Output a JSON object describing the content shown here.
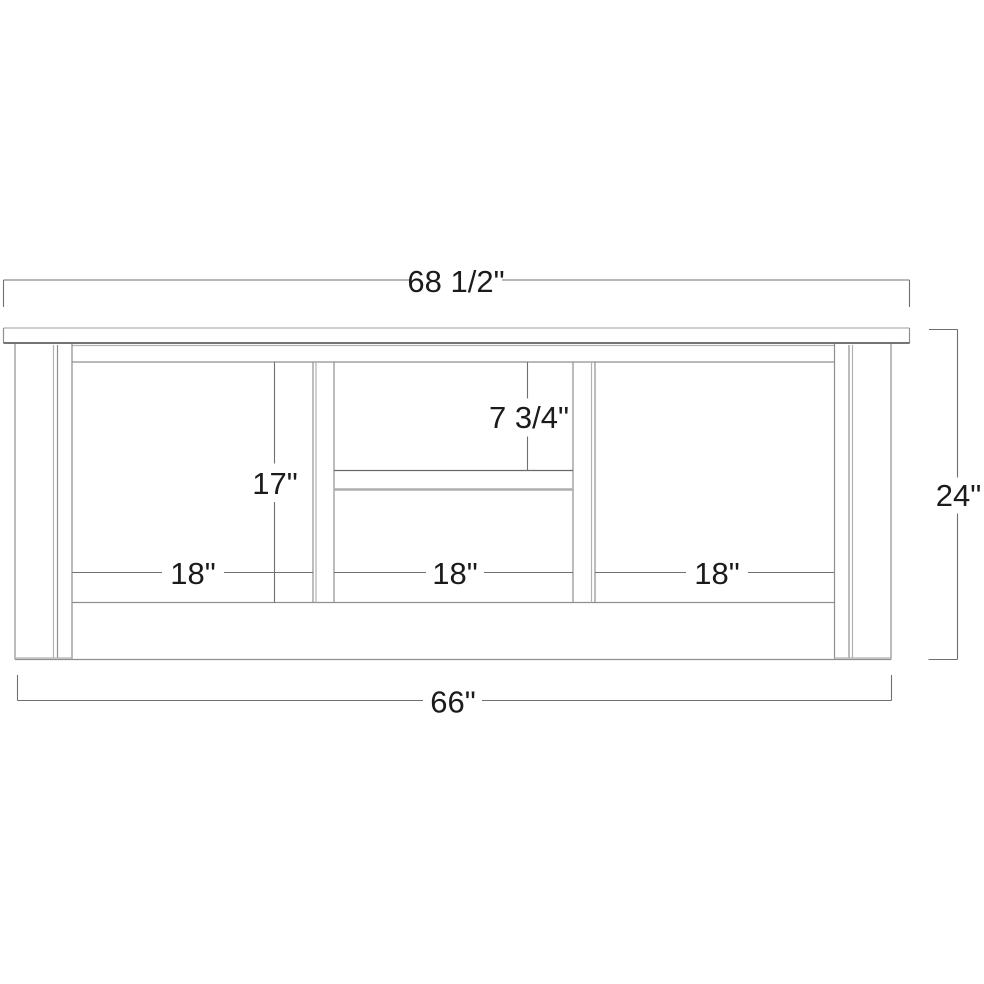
{
  "drawing": {
    "kind": "furniture dimension drawing (front elevation of a three-bay console cabinet)",
    "labels": {
      "top_width": "68 1/2\"",
      "overall_height": "24\"",
      "base_width": "66\"",
      "opening_height": "17\"",
      "shelf_to_top": "7 3/4\"",
      "left_opening_width": "18\"",
      "center_opening_width": "18\"",
      "right_opening_width": "18\""
    },
    "colors": {
      "background": "#ffffff",
      "structure_line": "#8f8f8f",
      "structure_dark_line": "#474747",
      "structure_light_line": "#b2b2b2",
      "dimension_line": "#6f6f6f",
      "dimension_text": "#1b1b1b"
    }
  }
}
